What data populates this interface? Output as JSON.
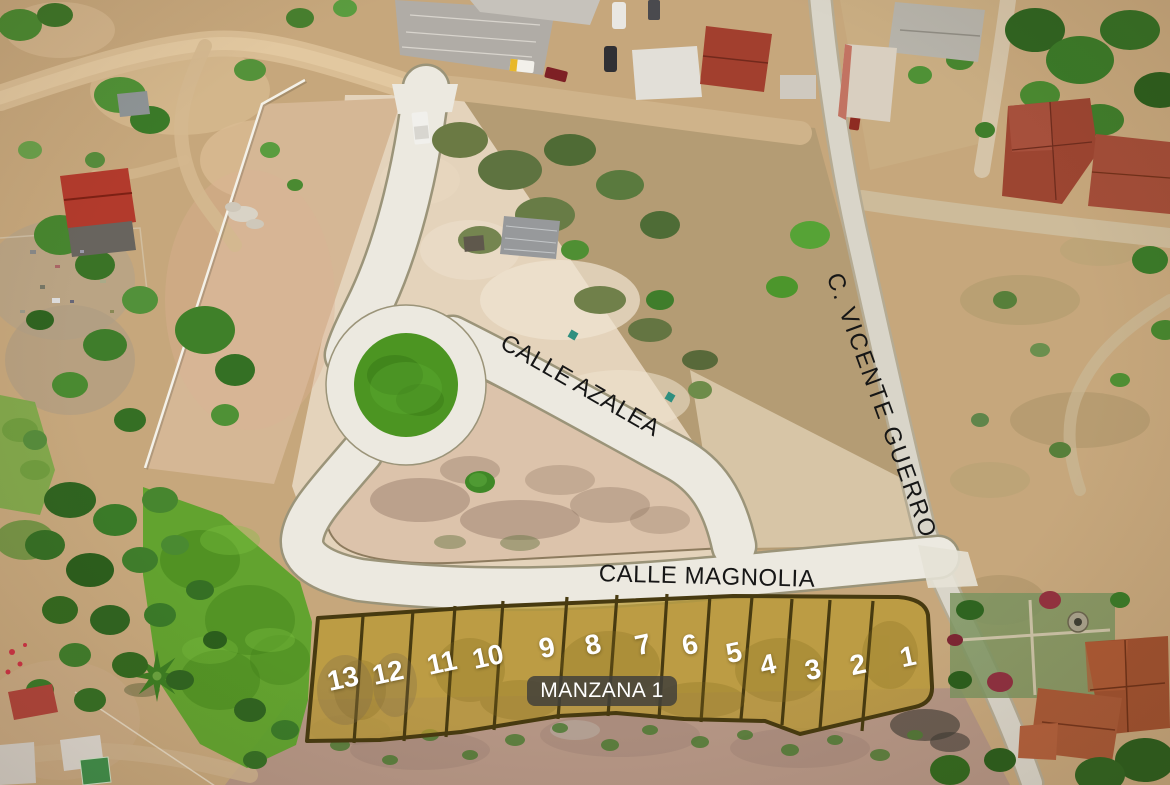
{
  "streets": {
    "azalea": {
      "label": "CALLE AZALEA"
    },
    "magnolia": {
      "label": "CALLE MAGNOLIA"
    },
    "vicente_guerro": {
      "label": "C. VICENTE GUERRO"
    }
  },
  "block": {
    "badge_label": "MANZANA 1",
    "lots": [
      {
        "number": "1"
      },
      {
        "number": "2"
      },
      {
        "number": "3"
      },
      {
        "number": "4"
      },
      {
        "number": "5"
      },
      {
        "number": "6"
      },
      {
        "number": "7"
      },
      {
        "number": "8"
      },
      {
        "number": "9"
      },
      {
        "number": "10"
      },
      {
        "number": "11"
      },
      {
        "number": "12"
      },
      {
        "number": "13"
      }
    ]
  },
  "colors": {
    "lot_fill": "#b8992f",
    "lot_border": "#473a10",
    "lot_number_text": "#ffffff",
    "park_overlay_green": "#57a327",
    "roundabout_green": "#4c9522",
    "paved_road": "#ece9e0",
    "street_label_text": "#161616",
    "badge_background": "#403f3a",
    "badge_text": "#ffffff"
  }
}
